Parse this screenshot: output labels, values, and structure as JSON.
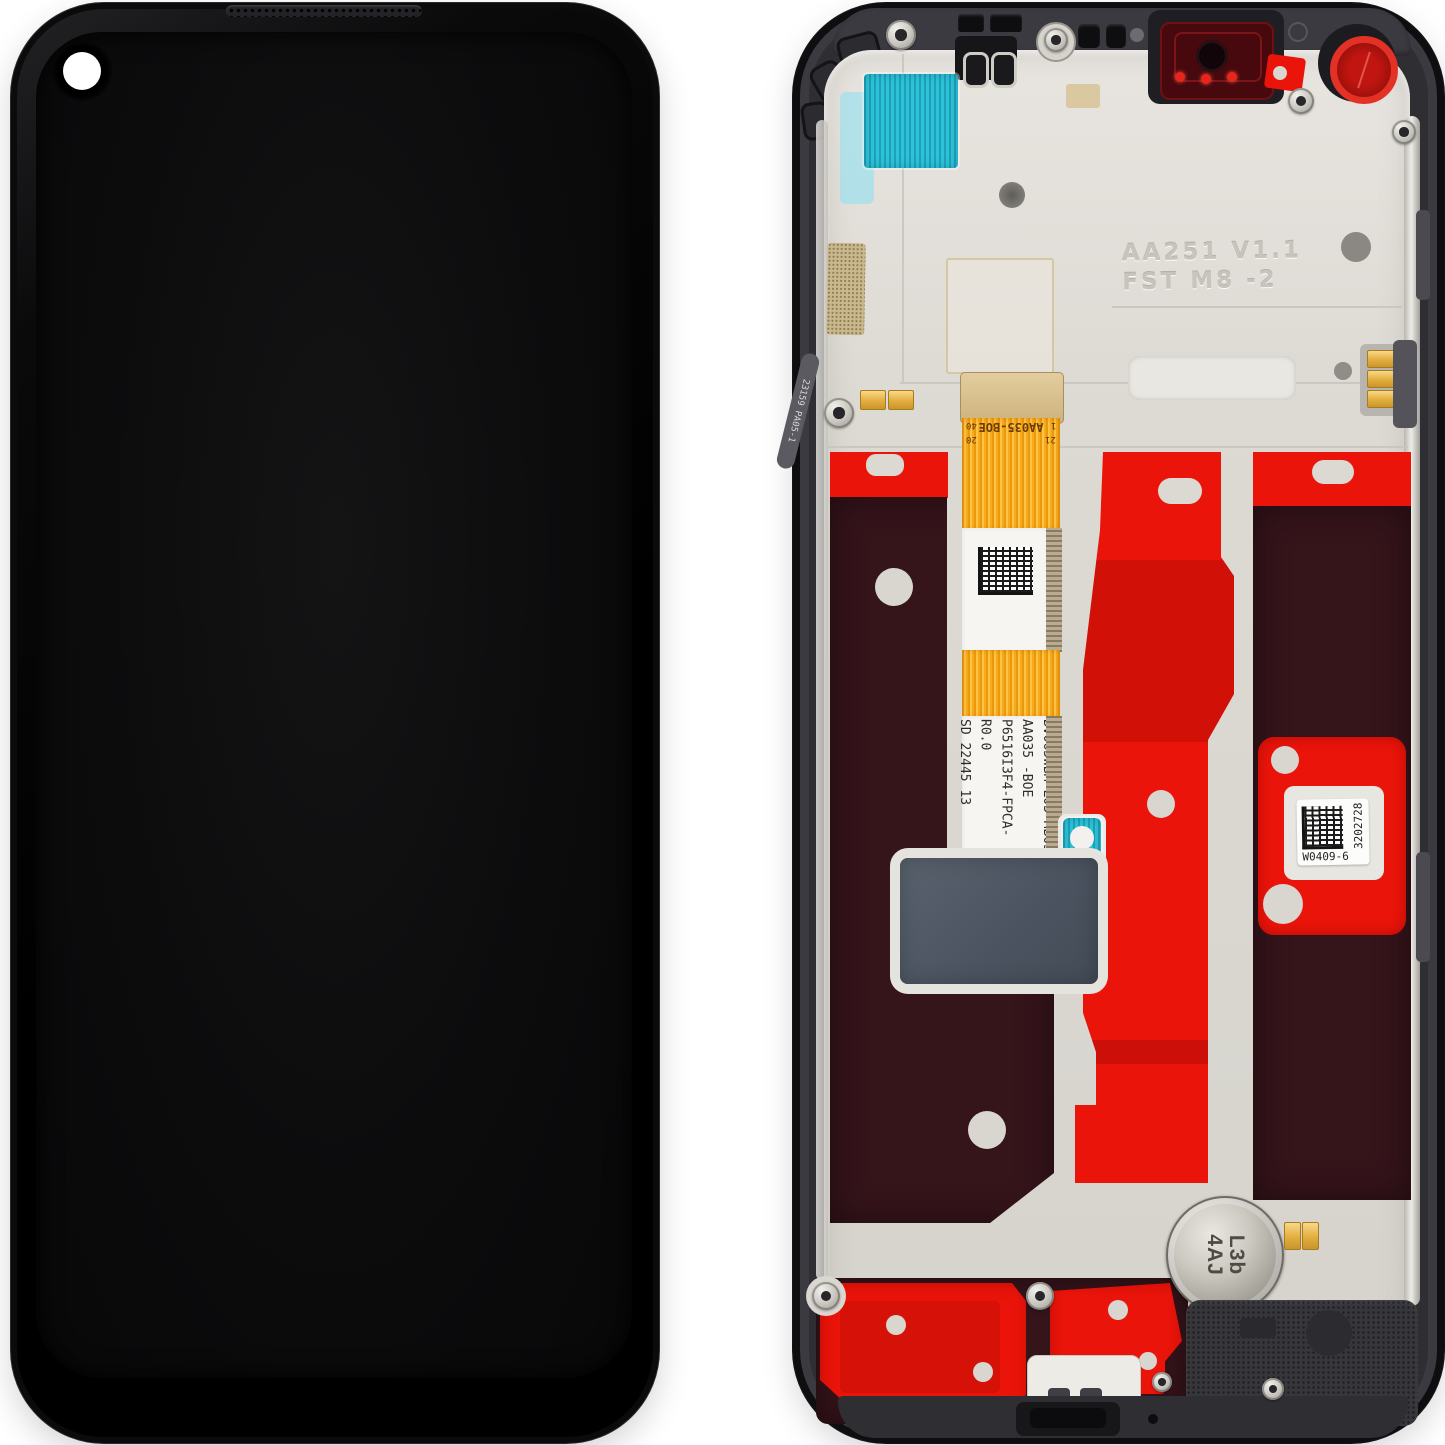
{
  "scene": {
    "type": "product-photo",
    "subject": "Smartphone LCD display assembly with frame — front and back views",
    "background_color": "#ffffff"
  },
  "front_view": {
    "description": "Assembled display front, black, screen off",
    "camera": "punch-hole top-left covered by white dot sticker",
    "colors": {
      "body": "#060607",
      "screen": "#0d0d0e",
      "camera_sticker": "#ffffff"
    }
  },
  "back_view": {
    "description": "Rear of display unit: mid-frame, red adhesive liners, main flex cable",
    "labels": {
      "main_flex_line1": "BV065WBM-L03-MB03",
      "main_flex_line2": "AA035 -BOE",
      "main_flex_line3": "P6516I3F4-FPCA-R0.0",
      "main_flex_line4": "SD 22445 13",
      "connector_text": "AA035-BOE",
      "pin_1": "1",
      "pin_20": "20",
      "pin_21": "21",
      "pin_40": "40",
      "side_flex_text": "23159 PA05-1",
      "qr_label_code": "W0409-6",
      "qr_label_serial": "3202728",
      "motor_line1": "L3b",
      "motor_line2": "4AJ",
      "embossed_line1": "AA251 V1.1",
      "embossed_line2": "FST M8 -2"
    },
    "colors": {
      "frame": "#2e2e33",
      "plate": "#dcd9d3",
      "adhesive_red": "#ea140a",
      "liner_maroon": "#35141a",
      "flex_orange": "#f6a918",
      "sticker_cyan": "#2cc3da",
      "graphite_pad": "#4e5763",
      "camera_window_red": "#47090d"
    }
  }
}
